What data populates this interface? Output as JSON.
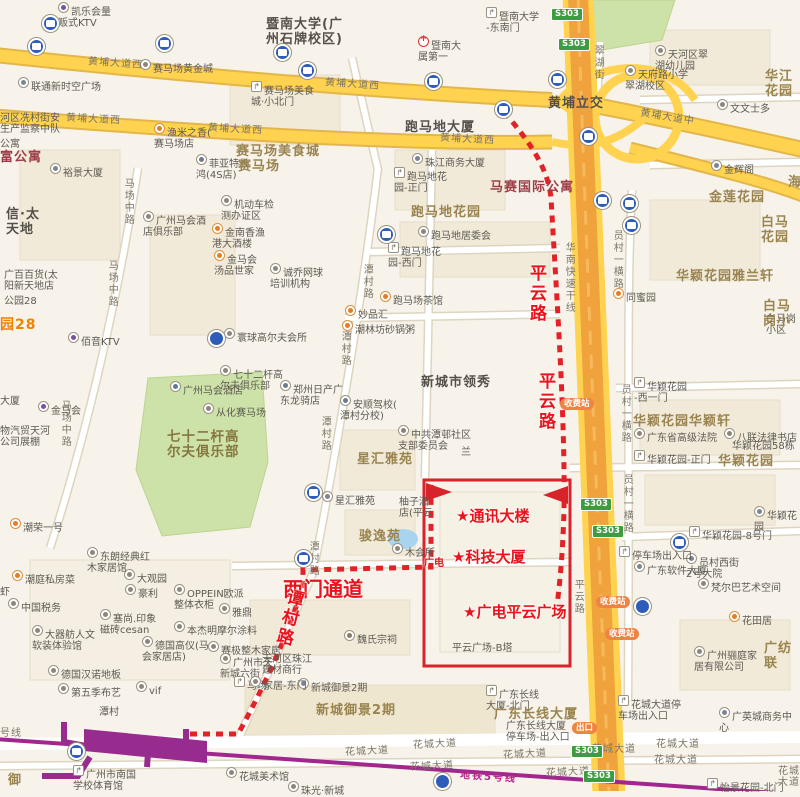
{
  "map": {
    "title_note": "route map to 广电计量 (Guangzhou)",
    "colors": {
      "background": "#f7f3ea",
      "road_yellow": "#ffd34f",
      "expressway_orange": "#f0a23c",
      "green_area": "#cde2a8",
      "metro_purple": "#9a2c8c",
      "annotation_red": "#e8131c",
      "route_red": "#e32228",
      "s303_green": "#3d9b42",
      "toll_orange": "#ef8341",
      "location_blue": "#1e78f0"
    },
    "callouts": [
      {
        "name": "bus-stop-callout",
        "lines": [
          "公交站",
          "华侨医院",
          "（谭村）"
        ],
        "x": 458,
        "y": 18,
        "w": 82,
        "h": 84,
        "font": 13.5
      },
      {
        "name": "destination-callout",
        "lines": [
          "广电",
          "计量"
        ],
        "x": 465,
        "y": 426,
        "w": 64,
        "h": 70,
        "font": 15
      },
      {
        "name": "metro-exit-callout",
        "lines": [
          "谭村",
          "地铁",
          "C出口"
        ],
        "x": 156,
        "y": 644,
        "w": 60,
        "h": 66,
        "font": 12.5
      }
    ],
    "red_annotations": [
      {
        "t": "平云路",
        "x": 524,
        "y": 264,
        "size": 17,
        "v": true
      },
      {
        "t": "平云路",
        "x": 533,
        "y": 372,
        "size": 17,
        "v": true
      },
      {
        "t": "西门通道",
        "x": 283,
        "y": 573,
        "size": 20
      },
      {
        "t": "谭村路",
        "x": 276,
        "y": 588,
        "size": 17,
        "v": true,
        "rot": 14
      },
      {
        "t": "★通讯大楼",
        "x": 456,
        "y": 505,
        "size": 15
      },
      {
        "t": "★科技大厦",
        "x": 452,
        "y": 546,
        "size": 15
      },
      {
        "t": "★广电平云广场",
        "x": 463,
        "y": 601,
        "size": 15
      },
      {
        "t": "广电",
        "x": 424,
        "y": 554,
        "size": 10
      }
    ],
    "area_labels": [
      {
        "t": "暨南大学(广\n州石牌校区)",
        "x": 266,
        "y": 18,
        "cls": "dark"
      },
      {
        "t": "跑马地大厦",
        "x": 405,
        "y": 121,
        "cls": "dark"
      },
      {
        "t": "黄埔立交",
        "x": 548,
        "y": 97,
        "cls": "dark"
      },
      {
        "t": "马赛国际公寓",
        "x": 490,
        "y": 181,
        "cls": "maroon"
      },
      {
        "t": "跑马地花园",
        "x": 411,
        "y": 206,
        "cls": ""
      },
      {
        "t": "新城市领秀",
        "x": 421,
        "y": 376,
        "cls": "dark"
      },
      {
        "t": "星汇雅苑",
        "x": 357,
        "y": 453,
        "cls": ""
      },
      {
        "t": "骏逸苑",
        "x": 359,
        "y": 530,
        "cls": ""
      },
      {
        "t": "七十二杆高\n尔夫俱乐部",
        "x": 167,
        "y": 430,
        "cls": "golf"
      },
      {
        "t": "赛马场美食城",
        "x": 236,
        "y": 145,
        "cls": ""
      },
      {
        "t": "赛马场",
        "x": 238,
        "y": 160,
        "cls": ""
      },
      {
        "t": "新城御景2期",
        "x": 316,
        "y": 704,
        "cls": ""
      },
      {
        "t": "广东长线大厦",
        "x": 494,
        "y": 708,
        "cls": ""
      },
      {
        "t": "华颖花园雅兰轩",
        "x": 676,
        "y": 270,
        "cls": ""
      },
      {
        "t": "华颖花园华颖轩",
        "x": 633,
        "y": 415,
        "cls": ""
      },
      {
        "t": "华颖花园",
        "x": 718,
        "y": 455,
        "cls": ""
      },
      {
        "t": "金莲花园",
        "x": 709,
        "y": 191,
        "cls": ""
      },
      {
        "t": "白马花园",
        "x": 761,
        "y": 216,
        "cls": ""
      },
      {
        "t": "白马岗小",
        "x": 763,
        "y": 300,
        "cls": ""
      },
      {
        "t": "华江花园",
        "x": 765,
        "y": 70,
        "cls": ""
      },
      {
        "t": "广纺联",
        "x": 764,
        "y": 642,
        "cls": ""
      },
      {
        "t": "富公寓",
        "x": 0,
        "y": 151,
        "cls": "maroon"
      },
      {
        "t": "信·太\n天地",
        "x": 6,
        "y": 208,
        "cls": "dark"
      },
      {
        "t": "园28",
        "x": 0,
        "y": 318,
        "cls": "orange-bold"
      },
      {
        "t": "御",
        "x": 8,
        "y": 774,
        "cls": ""
      },
      {
        "t": "海",
        "x": 788,
        "y": 176,
        "cls": ""
      }
    ],
    "poi_labels": [
      {
        "t": "凯乐会量\n贩式KTV",
        "x": 70,
        "y": 2,
        "icon": "ktv"
      },
      {
        "t": "联通新时空广场",
        "x": 30,
        "y": 77,
        "icon": "building"
      },
      {
        "t": "河区冼村街安\n生产监察中队",
        "x": 0,
        "y": 113
      },
      {
        "t": "公寓",
        "x": 0,
        "y": 139
      },
      {
        "t": "裕景大厦",
        "x": 62,
        "y": 163,
        "icon": "building"
      },
      {
        "t": "渔米之香(\n赛马场店",
        "x": 166,
        "y": 123,
        "icon": "food"
      },
      {
        "t": "菲亚特长\n鸿(4S店)",
        "x": 208,
        "y": 154,
        "icon": "car"
      },
      {
        "t": "赛马场黄金城",
        "x": 152,
        "y": 59,
        "icon": "poi"
      },
      {
        "t": "赛马场美食\n城·小北门",
        "x": 263,
        "y": 81,
        "icon": "gate"
      },
      {
        "t": "暨南大学\n-东南门",
        "x": 498,
        "y": 7,
        "icon": "gate"
      },
      {
        "t": "暨南大\n属第一",
        "x": 430,
        "y": 36,
        "icon": "hospital"
      },
      {
        "t": "珠江商务大厦",
        "x": 424,
        "y": 153,
        "icon": "building"
      },
      {
        "t": "跑马地花\n园-正门",
        "x": 406,
        "y": 167,
        "icon": "gate"
      },
      {
        "t": "跑马地居委会",
        "x": 430,
        "y": 226,
        "icon": "poi"
      },
      {
        "t": "跑马地花\n园-西门",
        "x": 400,
        "y": 242,
        "icon": "gate"
      },
      {
        "t": "跑马场茶馆",
        "x": 392,
        "y": 291,
        "icon": "food"
      },
      {
        "t": "妙品汇",
        "x": 357,
        "y": 305,
        "icon": "food"
      },
      {
        "t": "潮林坊砂锅粥",
        "x": 354,
        "y": 320,
        "icon": "food"
      },
      {
        "t": "诚乔网球\n培训机构",
        "x": 282,
        "y": 263,
        "icon": "poi"
      },
      {
        "t": "机动车检\n测办证区",
        "x": 233,
        "y": 195,
        "icon": "poi"
      },
      {
        "t": "金南香渔\n港大酒楼",
        "x": 224,
        "y": 223,
        "icon": "food"
      },
      {
        "t": "金马会\n汤品世家",
        "x": 226,
        "y": 250,
        "icon": "food"
      },
      {
        "t": "寰球高尔夫会所",
        "x": 236,
        "y": 328,
        "icon": "poi"
      },
      {
        "t": "七十二杆高\n尔夫俱乐部",
        "x": 232,
        "y": 365,
        "icon": "poi"
      },
      {
        "t": "广州马会酒\n店俱乐部",
        "x": 155,
        "y": 211,
        "icon": "poi"
      },
      {
        "t": "广州马会酒店",
        "x": 182,
        "y": 381,
        "icon": "hotel"
      },
      {
        "t": "从化赛马场",
        "x": 215,
        "y": 403,
        "icon": "poi"
      },
      {
        "t": "金马会",
        "x": 50,
        "y": 401,
        "icon": "ktv"
      },
      {
        "t": "物汽贸天河\n公司展棚",
        "x": 0,
        "y": 426
      },
      {
        "t": "大厦",
        "x": 0,
        "y": 396
      },
      {
        "t": "广百百货(太\n阳新天地店",
        "x": 4,
        "y": 270
      },
      {
        "t": "公园28",
        "x": 4,
        "y": 296
      },
      {
        "t": "佰音KTV",
        "x": 80,
        "y": 332,
        "icon": "ktv"
      },
      {
        "t": "潮荣一号",
        "x": 22,
        "y": 518,
        "icon": "food"
      },
      {
        "t": "潮庭私房菜",
        "x": 24,
        "y": 570,
        "icon": "food"
      },
      {
        "t": "虾",
        "x": 0,
        "y": 587
      },
      {
        "t": "中国税务",
        "x": 20,
        "y": 598,
        "icon": "poi"
      },
      {
        "t": "大器舫人文\n软装体验馆",
        "x": 44,
        "y": 625,
        "icon": "poi"
      },
      {
        "t": "德国汉诺地板",
        "x": 60,
        "y": 665,
        "icon": "poi"
      },
      {
        "t": "第五季布艺",
        "x": 70,
        "y": 683,
        "icon": "poi"
      },
      {
        "t": "塞尚.印象\n磁砖cesan",
        "x": 112,
        "y": 609,
        "icon": "poi"
      },
      {
        "t": "豪利",
        "x": 137,
        "y": 584,
        "icon": "poi"
      },
      {
        "t": "大观园",
        "x": 136,
        "y": 569,
        "icon": "poi"
      },
      {
        "t": "东朗经典红\n木家居馆",
        "x": 99,
        "y": 547,
        "icon": "poi"
      },
      {
        "t": "OPPEIN欧派\n整体衣柜",
        "x": 186,
        "y": 584,
        "icon": "poi"
      },
      {
        "t": "雅鼎",
        "x": 231,
        "y": 603,
        "icon": "poi"
      },
      {
        "t": "本杰明摩尔涂料",
        "x": 186,
        "y": 621,
        "icon": "poi"
      },
      {
        "t": "德国高仪(马\n会家居店)",
        "x": 154,
        "y": 636,
        "icon": "poi"
      },
      {
        "t": "赛极整木家居",
        "x": 220,
        "y": 641,
        "icon": "poi"
      },
      {
        "t": "广州市天\n新城六街",
        "x": 232,
        "y": 653,
        "icon": "poi"
      },
      {
        "t": "马场",
        "x": 246,
        "y": 676,
        "icon": "gate"
      },
      {
        "t": "vif",
        "x": 148,
        "y": 681,
        "icon": "poi"
      },
      {
        "t": "潭村",
        "x": 99,
        "y": 707
      },
      {
        "t": "广州市南国\n学校体育馆",
        "x": 85,
        "y": 765,
        "icon": "gate"
      },
      {
        "t": "珠光·新城",
        "x": 300,
        "y": 781,
        "icon": "poi"
      },
      {
        "t": "花城美术馆",
        "x": 238,
        "y": 767,
        "icon": "poi"
      },
      {
        "t": "郑州日产广\n东龙骑店",
        "x": 292,
        "y": 380,
        "icon": "car"
      },
      {
        "t": "安顺驾校(\n潭村分校)",
        "x": 352,
        "y": 395,
        "icon": "car"
      },
      {
        "t": "中共潭邨社区\n支部委员会",
        "x": 410,
        "y": 425,
        "icon": "gov"
      },
      {
        "t": "星汇雅苑",
        "x": 334,
        "y": 491,
        "icon": "building"
      },
      {
        "t": "柚子酒\n店(平云",
        "x": 399,
        "y": 497
      },
      {
        "t": "木会所",
        "x": 404,
        "y": 543,
        "icon": "poi"
      },
      {
        "t": "兰",
        "x": 461,
        "y": 447
      },
      {
        "t": "魏氏宗祠",
        "x": 356,
        "y": 630,
        "icon": "temple"
      },
      {
        "t": "新城御景2期",
        "x": 310,
        "y": 678,
        "icon": "building"
      },
      {
        "t": "天河区珠江\n建材商行",
        "x": 262,
        "y": 654
      },
      {
        "t": "家居-东门",
        "x": 262,
        "y": 676,
        "icon": "poi"
      },
      {
        "t": "广东长线\n大厦-北门",
        "x": 498,
        "y": 685,
        "icon": "gate"
      },
      {
        "t": "广东长线大厦\n停车场-出入口",
        "x": 506,
        "y": 721
      },
      {
        "t": "平云广场-B塔",
        "x": 452,
        "y": 643
      },
      {
        "t": "员村西街\n2号大院",
        "x": 698,
        "y": 553,
        "icon": "building"
      },
      {
        "t": "梵尔巴艺术空间",
        "x": 710,
        "y": 578,
        "icon": "poi"
      },
      {
        "t": "花田居",
        "x": 741,
        "y": 611,
        "icon": "food"
      },
      {
        "t": "广州骊庭家\n居有限公司",
        "x": 706,
        "y": 646,
        "icon": "poi"
      },
      {
        "t": "广英城商务中心",
        "x": 731,
        "y": 707,
        "icon": "building"
      },
      {
        "t": "花城大道停\n车场出入口",
        "x": 630,
        "y": 695,
        "icon": "gate"
      },
      {
        "t": "怡景花园-北门",
        "x": 719,
        "y": 778,
        "icon": "gate"
      },
      {
        "t": "停车场出入口",
        "x": 631,
        "y": 546,
        "icon": "gate"
      },
      {
        "t": "广东软件大厦",
        "x": 646,
        "y": 561,
        "icon": "building"
      },
      {
        "t": "华颖花园\n-西一门",
        "x": 646,
        "y": 377,
        "icon": "gate"
      },
      {
        "t": "广东省高级法院",
        "x": 646,
        "y": 428,
        "icon": "poi"
      },
      {
        "t": "八联法律书店",
        "x": 736,
        "y": 428,
        "icon": "poi"
      },
      {
        "t": "华颖花园58栋",
        "x": 732,
        "y": 441
      },
      {
        "t": "华颖花园-正门",
        "x": 646,
        "y": 450,
        "icon": "gate"
      },
      {
        "t": "华颖花园",
        "x": 766,
        "y": 506,
        "icon": "building"
      },
      {
        "t": "华颖花园-8号门",
        "x": 701,
        "y": 526,
        "icon": "gate"
      },
      {
        "t": "同蜜园",
        "x": 625,
        "y": 288,
        "icon": "food"
      },
      {
        "t": "文文士多",
        "x": 729,
        "y": 99,
        "icon": "poi"
      },
      {
        "t": "天河区翠\n湖幼儿园",
        "x": 667,
        "y": 45,
        "icon": "poi"
      },
      {
        "t": "天府路小学\n翠湖校区",
        "x": 637,
        "y": 65,
        "icon": "poi"
      },
      {
        "t": "金辉阁",
        "x": 723,
        "y": 160,
        "icon": "building"
      },
      {
        "t": "白马岗小区",
        "x": 766,
        "y": 314
      }
    ],
    "road_labels": [
      {
        "t": "黄埔大道西",
        "x": 88,
        "y": 58,
        "rot": 4
      },
      {
        "t": "黄埔大道西",
        "x": 325,
        "y": 79,
        "rot": 4
      },
      {
        "t": "黄埔大道西",
        "x": 66,
        "y": 114,
        "rot": 3
      },
      {
        "t": "黄埔大道西",
        "x": 208,
        "y": 124,
        "rot": 3
      },
      {
        "t": "黄埔大道西",
        "x": 440,
        "y": 134,
        "rot": 3
      },
      {
        "t": "黄埔大道中",
        "x": 640,
        "y": 112,
        "rot": 9
      },
      {
        "t": "马场中路",
        "x": 122,
        "y": 178,
        "v": true
      },
      {
        "t": "马场中路",
        "x": 106,
        "y": 260,
        "v": true
      },
      {
        "t": "马场中路",
        "x": 59,
        "y": 400,
        "v": true
      },
      {
        "t": "潭村路",
        "x": 361,
        "y": 264,
        "v": true
      },
      {
        "t": "潭村路",
        "x": 339,
        "y": 331,
        "v": true
      },
      {
        "t": "潭村路",
        "x": 319,
        "y": 416,
        "v": true
      },
      {
        "t": "潭村路",
        "x": 307,
        "y": 541,
        "v": true
      },
      {
        "t": "员村一横路",
        "x": 611,
        "y": 230,
        "v": true
      },
      {
        "t": "员村一横路",
        "x": 619,
        "y": 384,
        "v": true
      },
      {
        "t": "员村一横路",
        "x": 621,
        "y": 474,
        "v": true
      },
      {
        "t": "翠湖街",
        "x": 592,
        "y": 45,
        "v": true
      },
      {
        "t": "华南快速干线",
        "x": 563,
        "y": 242,
        "v": true
      },
      {
        "t": "平云路",
        "x": 572,
        "y": 579,
        "v": true
      },
      {
        "t": "花城大道",
        "x": 345,
        "y": 746,
        "rot": -3
      },
      {
        "t": "花城大道",
        "x": 413,
        "y": 739,
        "rot": -3
      },
      {
        "t": "花城大道",
        "x": 503,
        "y": 749,
        "rot": -3
      },
      {
        "t": "花城大道",
        "x": 410,
        "y": 761,
        "rot": -3
      },
      {
        "t": "花城大道",
        "x": 546,
        "y": 767,
        "rot": -3
      },
      {
        "t": "花城大道",
        "x": 592,
        "y": 744
      },
      {
        "t": "花城大道",
        "x": 656,
        "y": 739
      },
      {
        "t": "花城大道",
        "x": 654,
        "y": 755
      },
      {
        "t": "花城大道",
        "x": 778,
        "y": 766
      },
      {
        "t": "地铁5号线",
        "x": 460,
        "y": 772,
        "rot": 4,
        "cls": "mag"
      },
      {
        "t": "号线",
        "x": 0,
        "y": 728
      }
    ],
    "badges": {
      "s303_label": "S303",
      "s303": [
        [
          551,
          8
        ],
        [
          558,
          38
        ],
        [
          580,
          498
        ],
        [
          592,
          525
        ],
        [
          571,
          745
        ],
        [
          583,
          770
        ]
      ],
      "toll_label": "收费站",
      "toll": [
        [
          560,
          398
        ],
        [
          596,
          596
        ],
        [
          605,
          628
        ]
      ],
      "exit_label": "出口",
      "exit": [
        [
          572,
          722
        ]
      ]
    },
    "metro": {
      "station_label": "潭村",
      "logo_glyph": "Y",
      "exits": [
        {
          "letter": "A",
          "x": 28,
          "y": 769
        },
        {
          "letter": "B",
          "x": 140,
          "y": 763
        },
        {
          "letter": "C",
          "x": 179,
          "y": 716
        },
        {
          "letter": "D",
          "x": 57,
          "y": 710
        }
      ]
    },
    "icons": {
      "bus": [
        [
          48,
          21
        ],
        [
          34,
          44
        ],
        [
          162,
          41
        ],
        [
          280,
          50
        ],
        [
          305,
          68
        ],
        [
          431,
          79
        ],
        [
          501,
          107
        ],
        [
          555,
          77
        ],
        [
          586,
          134
        ],
        [
          600,
          198
        ],
        [
          627,
          201
        ],
        [
          629,
          223
        ],
        [
          384,
          232
        ],
        [
          311,
          490
        ],
        [
          301,
          556
        ],
        [
          677,
          540
        ],
        [
          74,
          749
        ]
      ],
      "parking": [
        [
          214,
          336
        ],
        [
          640,
          604
        ],
        [
          440,
          779
        ]
      ],
      "building": [
        [
          490,
          497
        ],
        [
          518,
          645
        ]
      ],
      "star": [
        [
          536,
          564
        ]
      ]
    },
    "location_dot": {
      "x": 602,
      "y": 511
    }
  }
}
